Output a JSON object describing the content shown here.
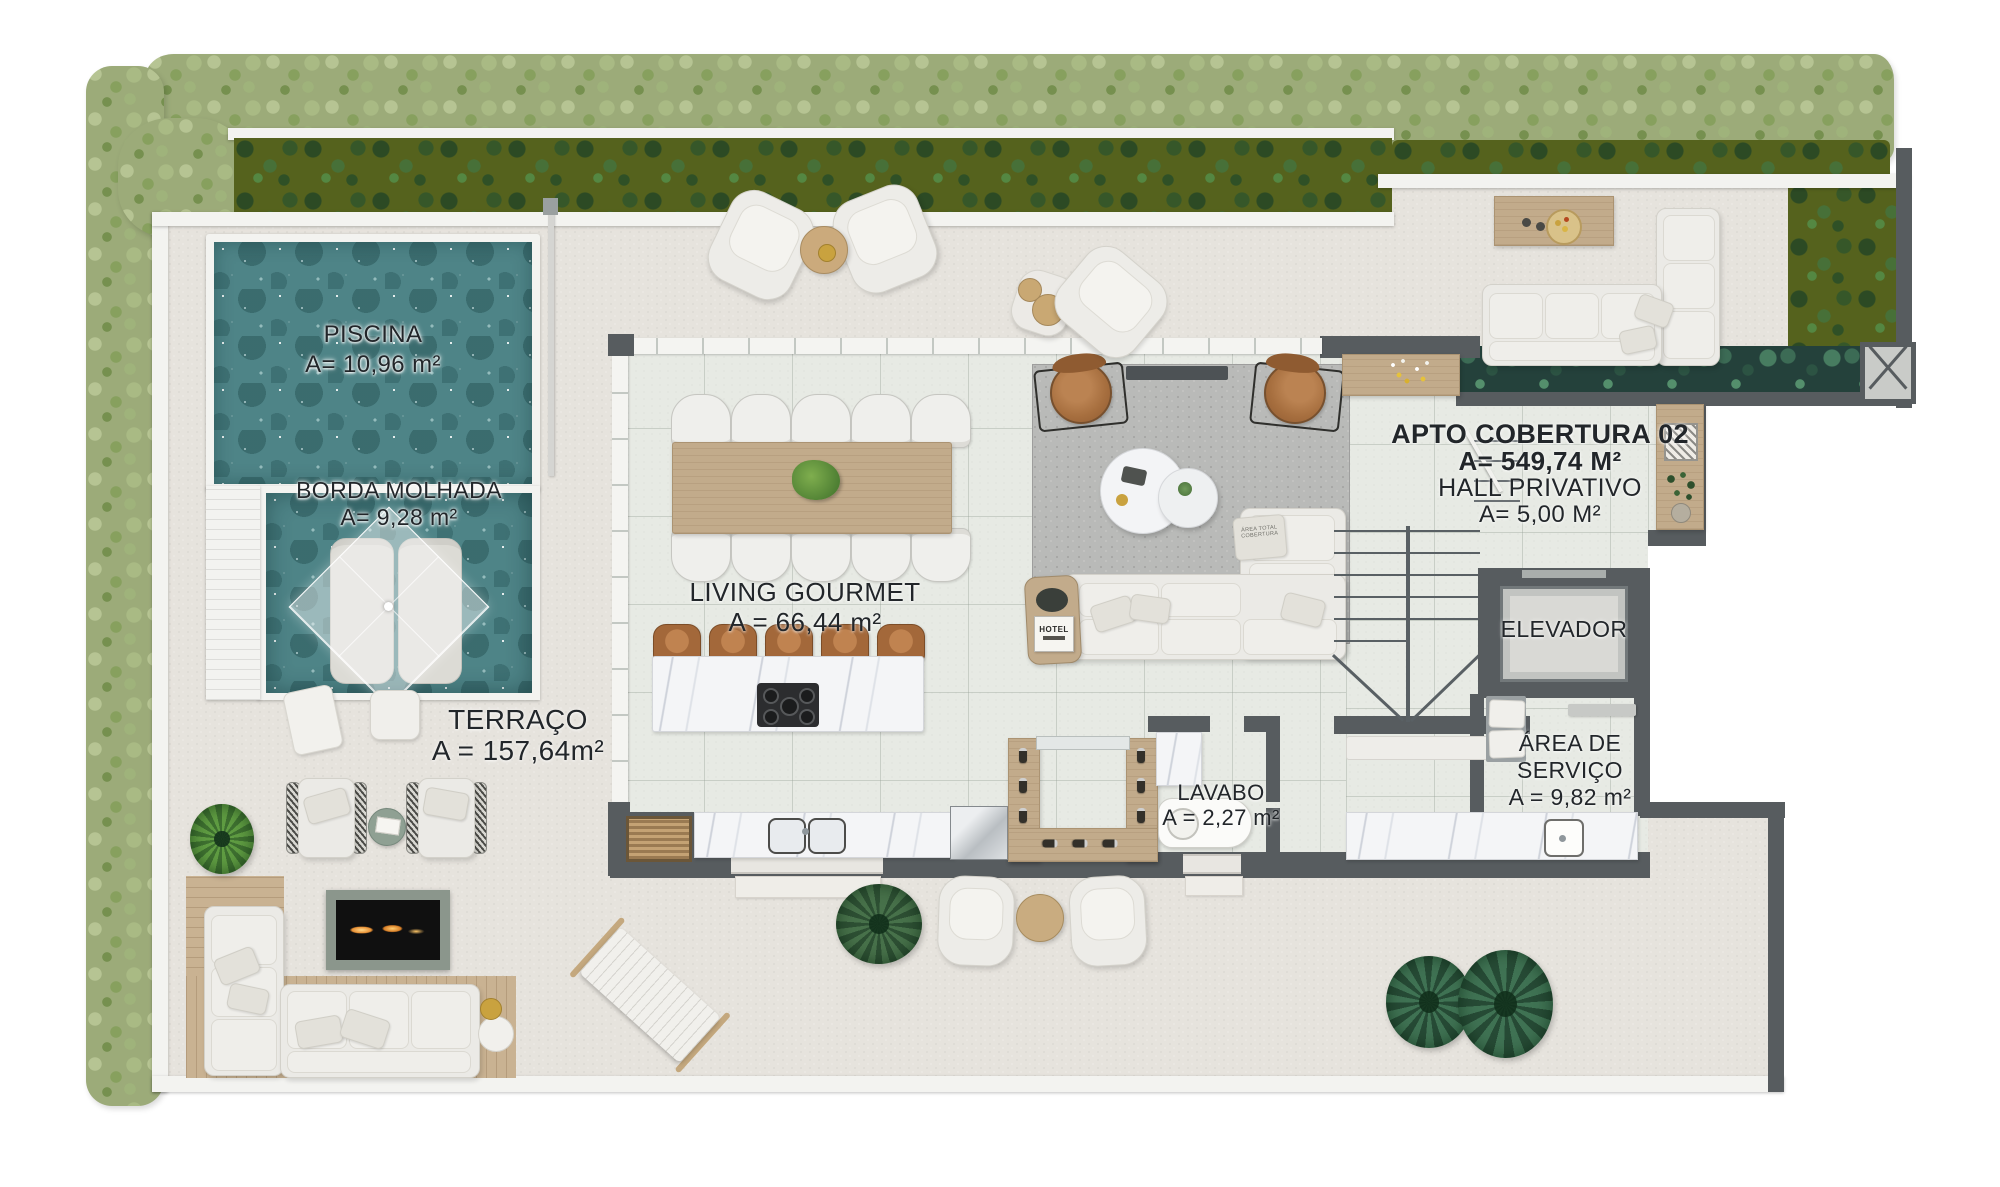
{
  "rooms": {
    "piscina": {
      "name": "PISCINA",
      "area": "A= 10,96 m²"
    },
    "borda_molhada": {
      "name": "BORDA MOLHADA",
      "area": "A= 9,28 m²"
    },
    "terraco": {
      "name": "TERRAÇO",
      "area": "A = 157,64m²"
    },
    "living_gourmet": {
      "name": "LIVING GOURMET",
      "area": "A = 66,44 m²"
    },
    "apto_cobertura": {
      "name": "APTO COBERTURA 02",
      "area": "A= 549,74 M²"
    },
    "hall_privativo": {
      "name": "HALL PRIVATIVO",
      "area": "A= 5,00 M²"
    },
    "elevador": {
      "name": "ELEVADOR"
    },
    "area_servico": {
      "name": "ÁREA DE SERVIÇO",
      "area": "A = 9,82 m²"
    },
    "lavabo": {
      "name": "LAVABO",
      "area": "A = 2,27 m²"
    }
  },
  "decor": {
    "hotel_book_title": "HOTEL",
    "sofa_pillow_print": "ÁREA TOTAL COBERTURA"
  },
  "colors": {
    "wall-dark": "#575c5f",
    "wall-white": "#f3f3f0",
    "terrace": "#e6e3dd",
    "tile": "#e7eae4",
    "pool": "#4e8487",
    "hedge": "#9cab79",
    "planter": "#55621d",
    "wood": "#c2ab8b",
    "deck": "#c9b292",
    "leather": "#a76f3f",
    "rug": "#b9bab8",
    "sofa": "#ebeae6",
    "marble": "#f4f5f7",
    "gold": "#c9a23f",
    "label": "#22262a"
  }
}
